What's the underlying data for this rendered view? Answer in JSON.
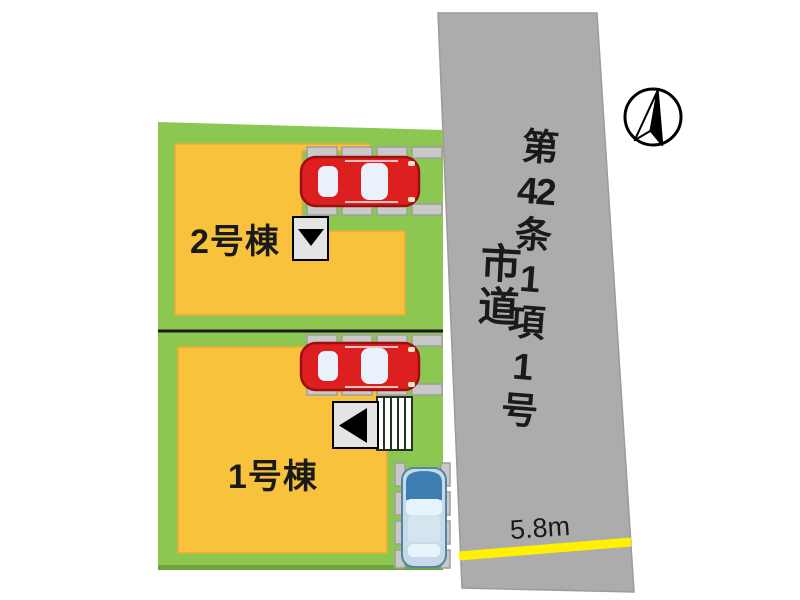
{
  "plan": {
    "buildings": [
      {
        "label": "1号棟"
      },
      {
        "label": "2号棟"
      }
    ],
    "road": {
      "name": "市道",
      "article": "第42条1項1号",
      "article_parts": [
        "第",
        "42",
        "条",
        "1",
        "項",
        "1",
        "号"
      ],
      "width": "5.8m"
    }
  },
  "icons": {
    "north_arrow": "north-arrow",
    "down_triangle": "▼",
    "left_triangle": "◀"
  },
  "colors": {
    "plot_green": "#8CC751",
    "plot_green_dark_edge": "#70A23E",
    "building_yellow": "#F9C23C",
    "building_yellow_edge": "#EBAA33",
    "road_gray": "#ACACAC",
    "width_line_yellow": "#FFF100",
    "car_red": "#DD1F1F",
    "car_red_outline": "#9E0E0E",
    "car_blue_body": "#C6DAE9",
    "car_blue_hood": "#3F7EB3",
    "parking_pad_gray": "#C9C9C9",
    "boundary_black": "#1A1A1A"
  }
}
